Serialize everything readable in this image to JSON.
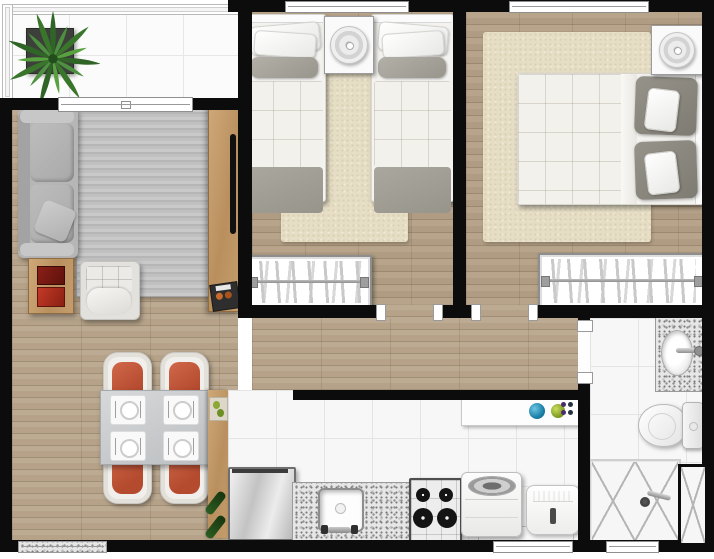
{
  "meta": {
    "title": "apartment-floor-plan",
    "description": "top-down photorealistic rendered floor plan of a two-bedroom apartment, no text labels visible",
    "canvas": {
      "width": 714,
      "height": 559
    }
  },
  "palette": {
    "wall": "#0c0c0c",
    "wood_floor": "#b5a289",
    "tile_floor": "#f7f7f7",
    "rug_gray": "#bfbfbf",
    "rug_beige": "#e6ddc5",
    "chair_seat_orange": "#c85a3c",
    "furniture_wood": "#c49a6b",
    "sofa_gray": "#b4b4b4",
    "plant_green": "#3f7d35",
    "bowl_blue": "#2a8fbd",
    "bowl_green": "#90a832",
    "bottle_green": "#2c5d22",
    "book_red": "#a83224"
  },
  "rooms": {
    "balcony": {
      "label": "balcony",
      "floor": "white-tile",
      "furniture": [
        "potted-plant",
        "glass-railing",
        "sliding-door"
      ]
    },
    "living_room": {
      "label": "living-room",
      "floor": "wood-plank",
      "furniture": [
        "gray-sofa",
        "throw-pillow",
        "armchair",
        "side-table-with-red-books",
        "striped-gray-rug",
        "tv-panel",
        "wall-tv",
        "decor-tray"
      ]
    },
    "dining_area": {
      "label": "dining-area",
      "floor": "wood-plank",
      "furniture": [
        "square-dining-table",
        "orange-chair",
        "place-setting",
        "wood-sideboard",
        "fruit-tray",
        "green-bottles"
      ]
    },
    "bedroom_twin": {
      "label": "twin-bedroom",
      "floor": "wood-plank",
      "furniture": [
        "twin-bed-left",
        "twin-bed-right",
        "nightstand-with-lamp",
        "t-shaped-beige-rug",
        "wardrobe-with-hangers",
        "window"
      ]
    },
    "bedroom_double": {
      "label": "double-bedroom",
      "floor": "wood-plank",
      "furniture": [
        "double-bed",
        "nightstand-with-lamp",
        "beige-shag-rug",
        "wardrobe-with-hangers",
        "window"
      ]
    },
    "hallway": {
      "label": "hallway",
      "floor": "wood-plank",
      "furniture": []
    },
    "kitchen": {
      "label": "kitchen",
      "floor": "white-tile",
      "furniture": [
        "refrigerator",
        "granite-countertop",
        "kitchen-sink",
        "gas-cooktop",
        "upper-counter-with-bowls"
      ]
    },
    "laundry_area": {
      "label": "laundry-area",
      "floor": "white-tile",
      "furniture": [
        "top-load-washer",
        "laundry-tank"
      ]
    },
    "bathroom": {
      "label": "bathroom",
      "floor": "white-tile",
      "furniture": [
        "granite-vanity",
        "oval-basin",
        "toilet",
        "glass-shower-box",
        "shower-mixer",
        "duct-shaft",
        "window"
      ]
    }
  },
  "counts": {
    "bedrooms": 2,
    "twin_beds": 2,
    "double_beds": 1,
    "dining_chairs": 4,
    "place_settings": 4,
    "stove_burners": 4,
    "wardrobes": 2,
    "windows": 5,
    "door_openings": 3
  }
}
